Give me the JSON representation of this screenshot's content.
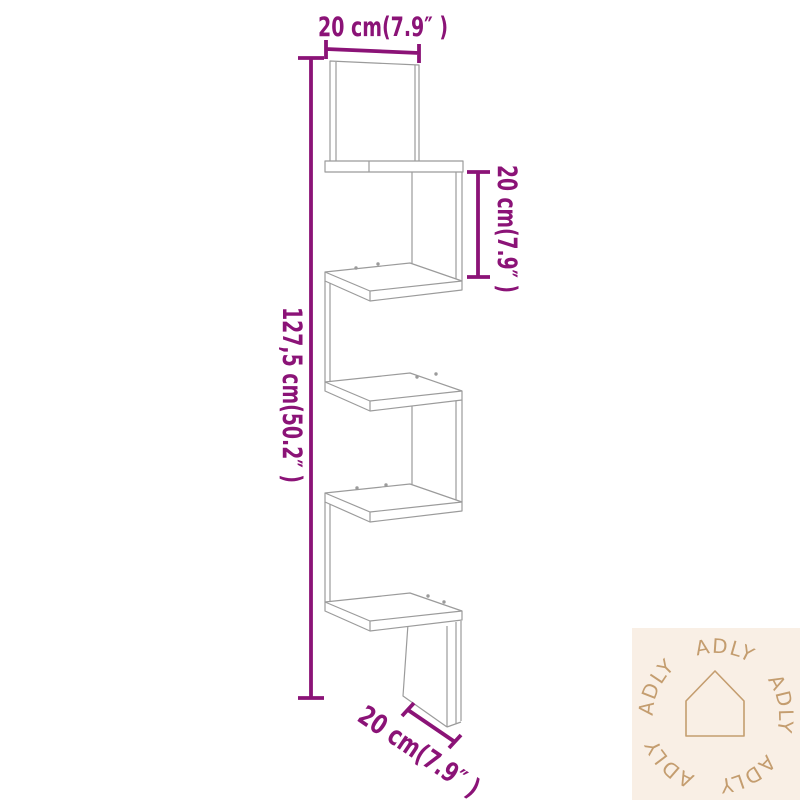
{
  "dimensions": {
    "top_width": "20 cm(7.9″ )",
    "right_shelf_gap": "20 cm(7.9″ )",
    "left_total_height": "127,5 cm(50.2″ )",
    "bottom_depth": "20 cm(7.9″ )"
  },
  "watermark": {
    "brand": "ADLY",
    "ring_text": "ADLY   ADLY   ADLY   ADLY   ADLY"
  },
  "colors": {
    "dimension_color": "#8b1377",
    "drawing_line_color": "#9b9b9b",
    "watermark_bg": "#f9efe5",
    "watermark_fg": "#c49d6f",
    "background_color": "#ffffff"
  }
}
